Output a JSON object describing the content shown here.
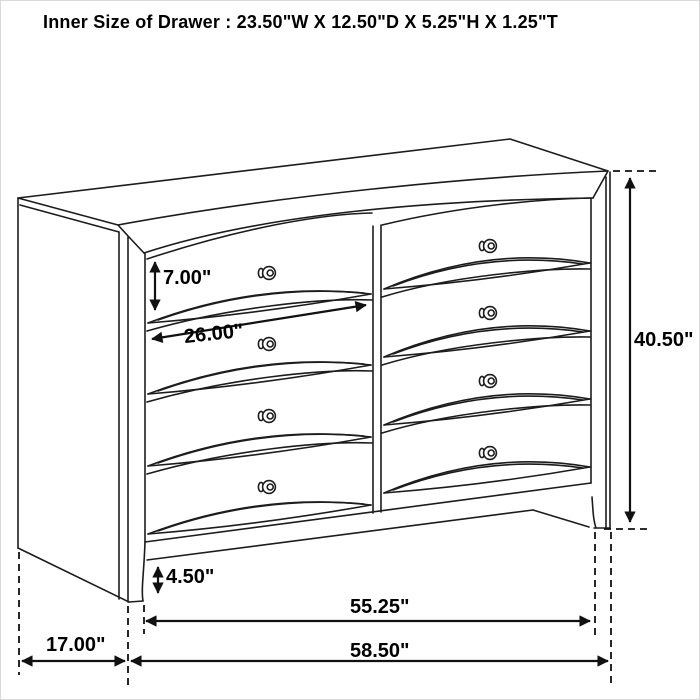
{
  "title": "Inner Size of Drawer : 23.50\"W X 12.50\"D X 5.25\"H X 1.25\"T",
  "dimension_labels": {
    "drawer_height": "7.00\"",
    "drawer_width": "26.00\"",
    "overall_height": "40.50\"",
    "base_height": "4.50\"",
    "front_width": "55.25\"",
    "overall_width": "58.50\"",
    "side_depth": "17.00\""
  },
  "figure": {
    "subject": "dresser line drawing",
    "drawer_rows": 4,
    "drawer_columns": 2,
    "visible_knobs": 8
  },
  "colors": {
    "line": "#1c1c1c",
    "background": "#ffffff"
  }
}
